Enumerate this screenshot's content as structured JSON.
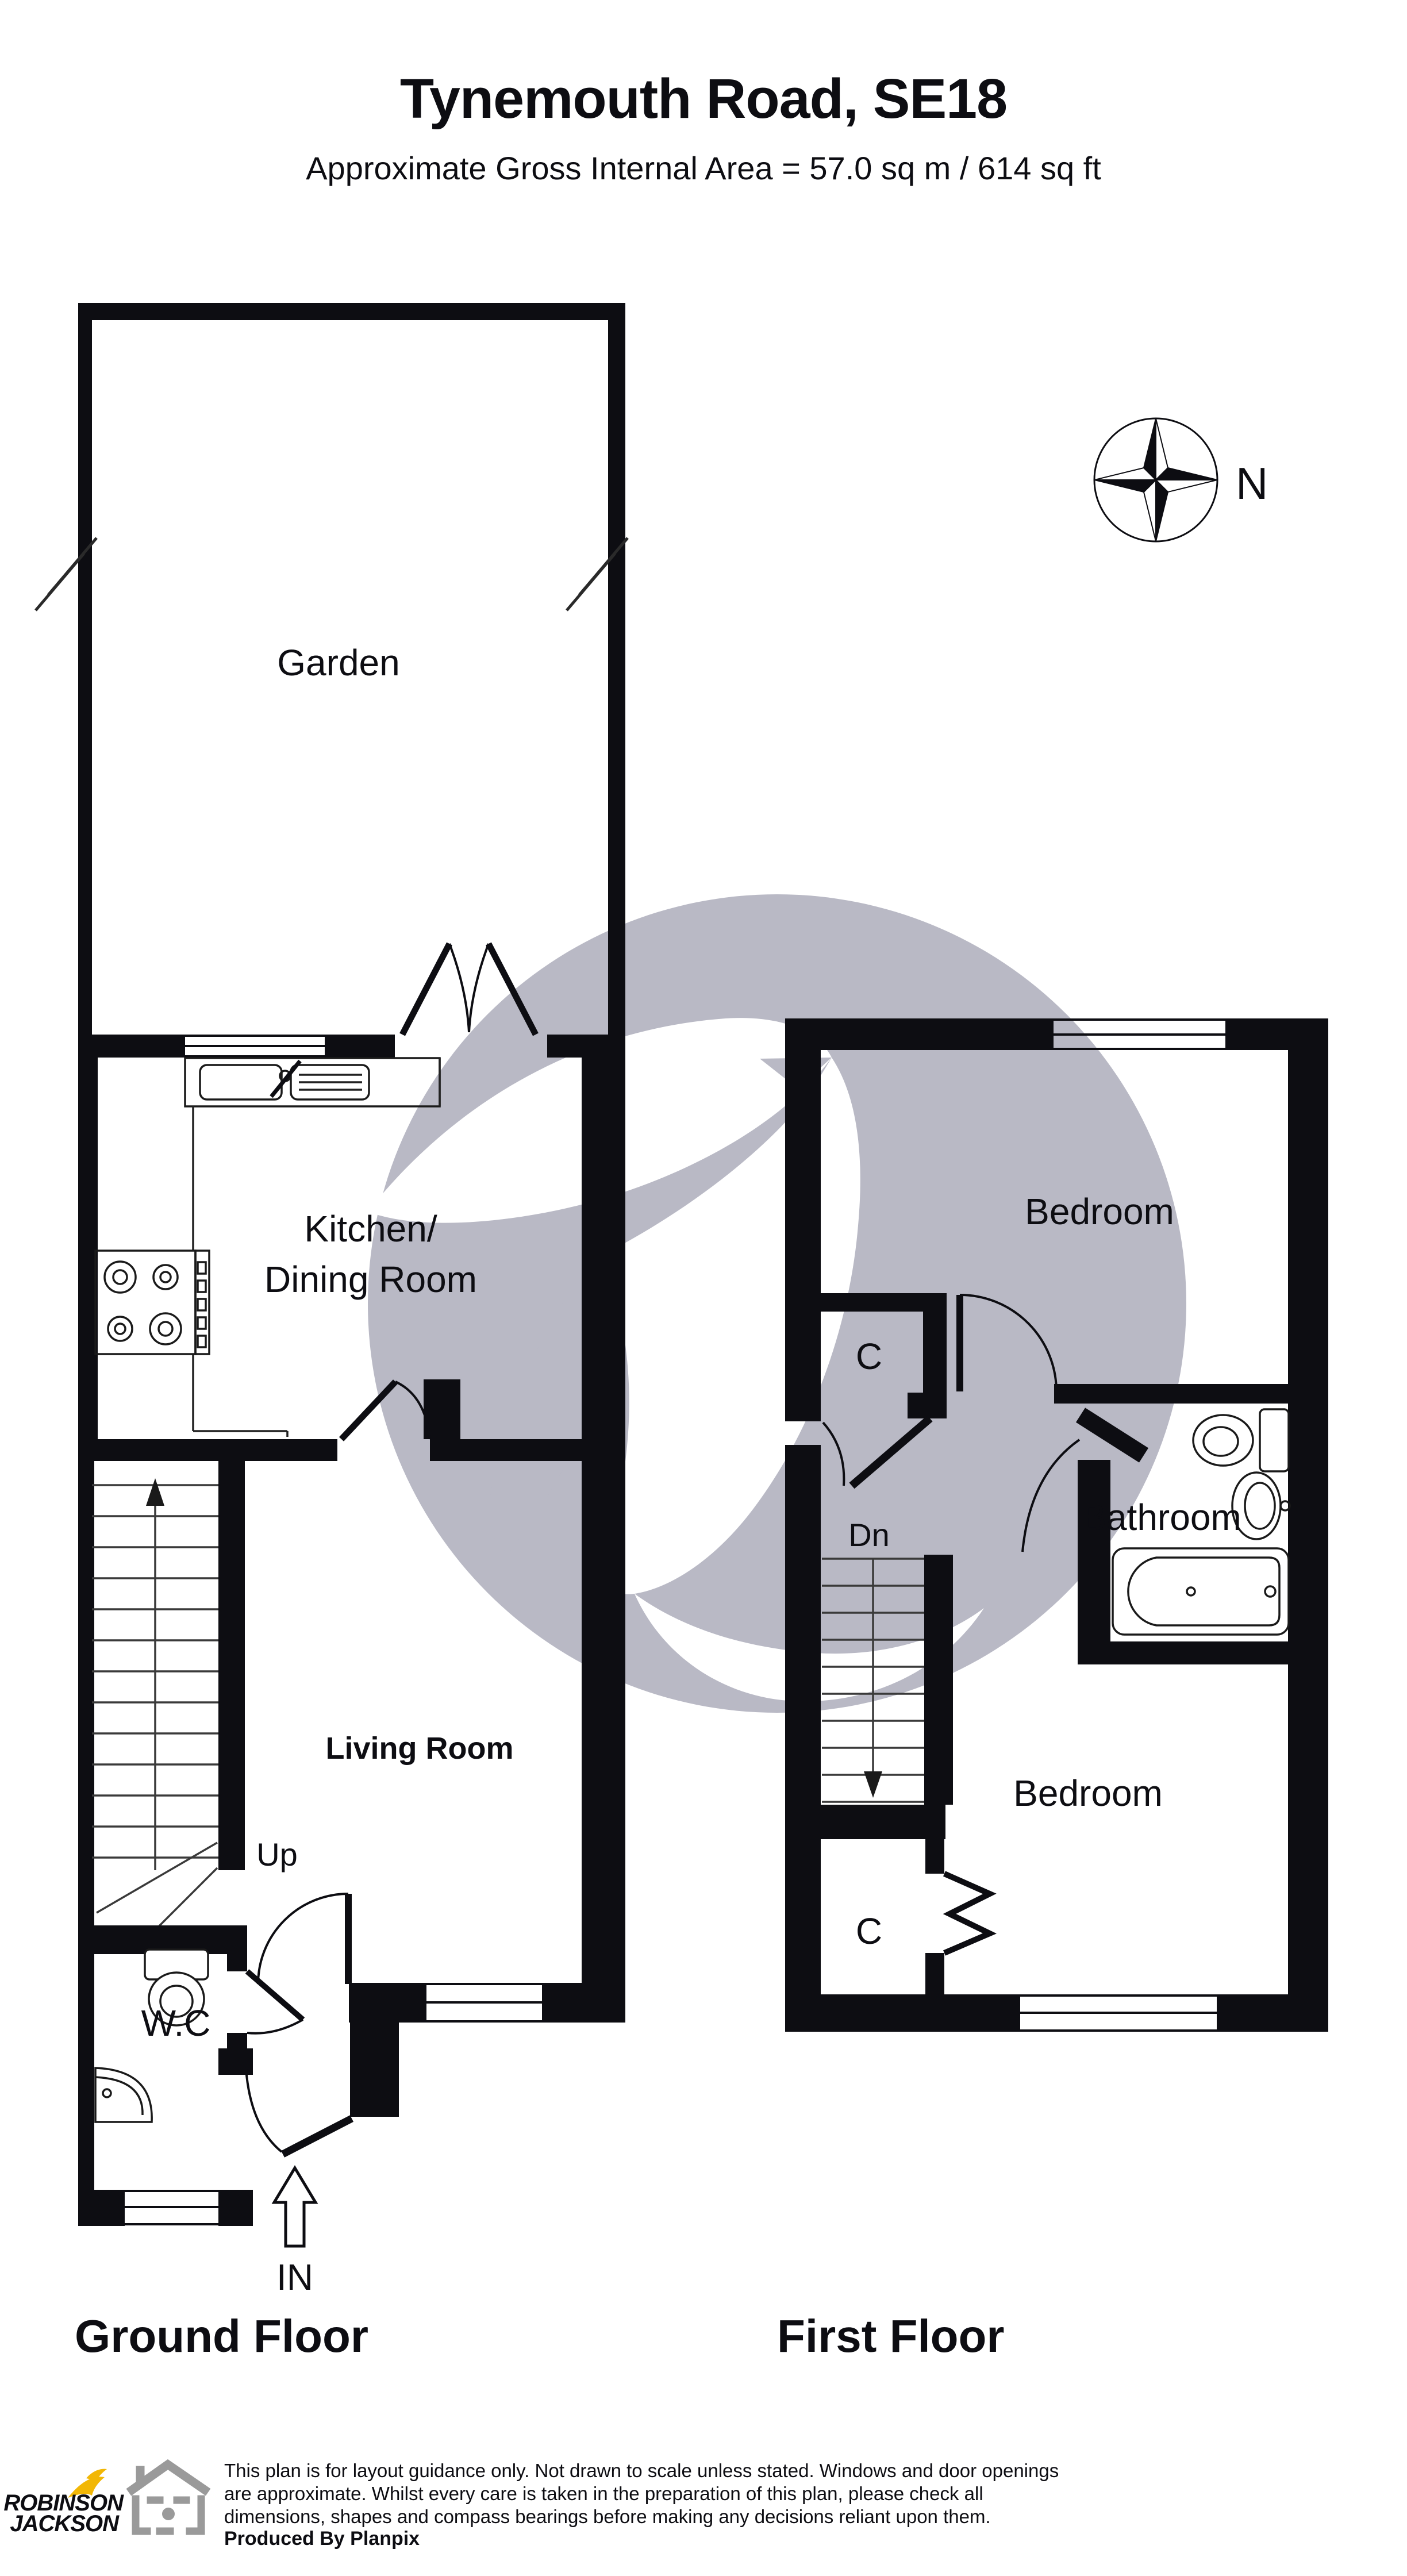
{
  "header": {
    "title": "Tynemouth Road, SE18",
    "subtitle": "Approximate Gross Internal Area = 57.0 sq m / 614 sq ft"
  },
  "compass": {
    "north_label": "N"
  },
  "ground_floor": {
    "name": "Ground Floor",
    "rooms": {
      "garden": "Garden",
      "kitchen_line1": "Kitchen/",
      "kitchen_line2": "Dining Room",
      "living_room": "Living Room",
      "wc": "W.C"
    },
    "stairs_label": "Up",
    "entrance_label": "IN"
  },
  "first_floor": {
    "name": "First Floor",
    "rooms": {
      "bedroom_back": "Bedroom",
      "bedroom_front": "Bedroom",
      "bathroom": "Bathroom",
      "closet_upper": "C",
      "closet_lower": "C"
    },
    "stairs_label": "Dn"
  },
  "footer": {
    "disclaimer_line1": "This plan is for layout guidance only. Not drawn to scale unless stated. Windows and door openings",
    "disclaimer_line2": "are approximate. Whilst every care is taken in the preparation of this plan, please check all",
    "disclaimer_line3": "dimensions, shapes and compass bearings before making any decisions reliant upon them.",
    "produced_by": "Produced By Planpix",
    "logo_line1": "ROBINSON",
    "logo_line2": "JACKSON"
  },
  "colors": {
    "wall_black": "#0d0d12",
    "watermark_gray": "#b9b9c5",
    "logo_navy": "#2d2f56",
    "logo_yellow": "#f2b705",
    "house_icon_gray": "#9a9a9a"
  }
}
